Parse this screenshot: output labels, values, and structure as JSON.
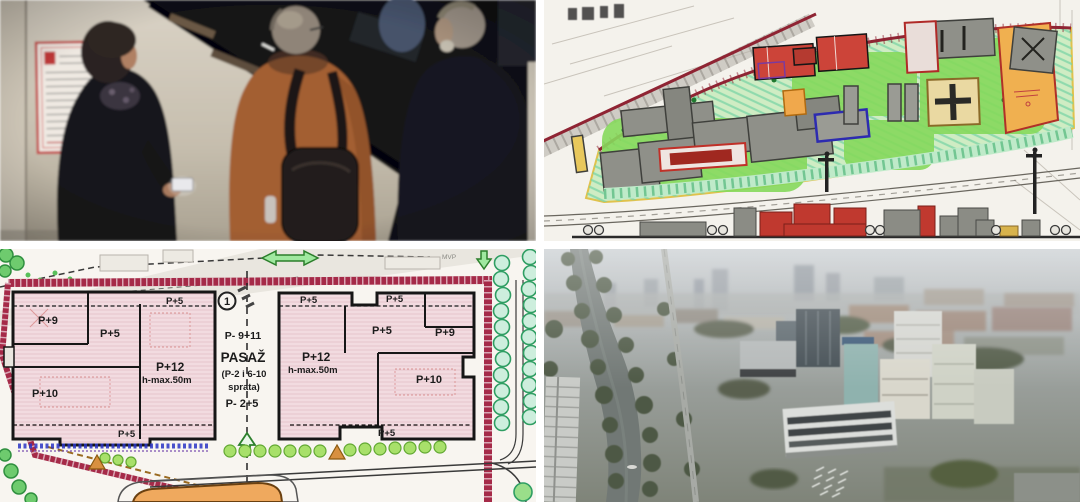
{
  "palette": {
    "gutter_white": "#ffffff",
    "boundary_red": "#a02a46",
    "plan_pink_fill": "#f5e3e7",
    "building_outline_black": "#161616",
    "planned_building_red": "#c8443a",
    "planned_building_gray": "#8f9089",
    "planned_building_orange": "#f0b050",
    "lawn_green": "#86d95c",
    "tree_green": "#3fae6e",
    "mint_hatch": "#7bd4a6",
    "blue_outline": "#2d2bb0",
    "blue_strip": "#2b35c5",
    "orange_arrow": "#d89040",
    "photo_wall_beige": "#cfc6b8",
    "coat_orange": "#a35f33",
    "river_gray_green": "#717875"
  },
  "bottom_left_plan": {
    "marker_1": "1",
    "mvp_label": "MVP",
    "left_block": {
      "p5_top_edge": "P+5",
      "p9": "P+9",
      "p5_inner": "P+5",
      "p12": "P+12",
      "p12_height": "h-max.50m",
      "p10": "P+10",
      "p5_bottom_edge": "P+5"
    },
    "passage": {
      "levels_top": "P- 9+11",
      "title": "PASAŽ",
      "note_line1": "(P-2 i 6-10",
      "note_line2": "sprata)",
      "levels_bottom": "P- 2+5"
    },
    "right_block": {
      "p5_top_edge_left": "P+5",
      "p5_top_edge_right": "P+5",
      "p5_inner": "P+5",
      "p9": "P+9",
      "p12": "P+12",
      "p12_height": "h-max.50m",
      "p10": "P+10",
      "p5_bottom_edge": "P+5"
    }
  }
}
